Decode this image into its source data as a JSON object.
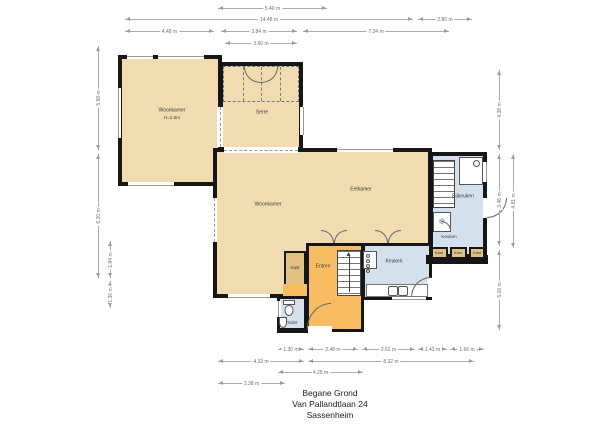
{
  "title": {
    "line1": "Begane Grond",
    "line2": "Van Pallandtlaan 24",
    "line3": "Sassenheim"
  },
  "colors": {
    "tan": "#f1dcb2",
    "tan2": "#e2c183",
    "orange": "#f8bc62",
    "blue": "#d4e1ec",
    "wall": "#161616",
    "dim_line": "#ababab",
    "dim_text": "#6f6f6f",
    "label_text": "#3c3c3c"
  },
  "plan": {
    "rooms": [
      {
        "id": "woonkamer-links",
        "x": 118,
        "y": 55,
        "w": 104,
        "h": 131,
        "fill": "tan",
        "bw": 4
      },
      {
        "id": "serre",
        "x": 219,
        "y": 62,
        "w": 84,
        "h": 89,
        "fill": "tan",
        "bw": 4
      },
      {
        "id": "woonkamer-eetkamer",
        "x": 213,
        "y": 148,
        "w": 219,
        "h": 150,
        "fill": "tan",
        "bw": 4
      },
      {
        "id": "bijkeuken",
        "x": 429,
        "y": 152,
        "w": 58,
        "h": 106,
        "fill": "blue",
        "bw": 4
      },
      {
        "id": "keuken",
        "x": 362,
        "y": 243,
        "w": 70,
        "h": 57,
        "fill": "blue",
        "bw": 3
      },
      {
        "id": "entree",
        "x": 306,
        "y": 243,
        "w": 58,
        "h": 89,
        "fill": "orange",
        "bw": 3
      },
      {
        "id": "kast-hal",
        "x": 284,
        "y": 251,
        "w": 22,
        "h": 36,
        "fill": "tan2",
        "bw": 2
      },
      {
        "id": "hal-strook",
        "x": 283,
        "y": 284,
        "w": 24,
        "h": 13,
        "fill": "orange",
        "noborder": true
      },
      {
        "id": "toilet",
        "x": 277,
        "y": 296,
        "w": 30,
        "h": 36,
        "fill": "blue",
        "bw": 3
      }
    ],
    "walls": [
      {
        "x": 426,
        "y": 255,
        "w": 62,
        "h": 9
      },
      {
        "x": 277,
        "y": 328,
        "w": 32,
        "h": 5
      }
    ],
    "windows": [
      {
        "x": 127,
        "y": 53,
        "w": 26,
        "h": 6,
        "o": "h"
      },
      {
        "x": 158,
        "y": 53,
        "w": 46,
        "h": 6,
        "o": "h"
      },
      {
        "x": 115,
        "y": 88,
        "w": 6,
        "h": 50,
        "o": "v"
      },
      {
        "x": 128,
        "y": 182,
        "w": 46,
        "h": 6,
        "o": "h"
      },
      {
        "x": 224,
        "y": 147,
        "w": 74,
        "h": 6,
        "o": "h",
        "dashed": true
      },
      {
        "x": 337,
        "y": 146,
        "w": 56,
        "h": 6,
        "o": "h"
      },
      {
        "x": 211,
        "y": 198,
        "w": 6,
        "h": 44,
        "o": "v",
        "dashed": true
      },
      {
        "x": 217,
        "y": 107,
        "w": 6,
        "h": 40,
        "o": "v",
        "dashed": true
      },
      {
        "x": 300,
        "y": 107,
        "w": 6,
        "h": 28,
        "o": "v"
      },
      {
        "x": 228,
        "y": 294,
        "w": 42,
        "h": 6,
        "o": "h"
      },
      {
        "x": 392,
        "y": 296,
        "w": 34,
        "h": 6,
        "o": "h"
      },
      {
        "x": 483,
        "y": 162,
        "w": 6,
        "h": 20,
        "o": "v"
      },
      {
        "x": 483,
        "y": 198,
        "w": 6,
        "h": 20,
        "o": "v",
        "door": true
      },
      {
        "x": 427,
        "y": 278,
        "w": 6,
        "h": 19,
        "o": "v",
        "door": true
      },
      {
        "x": 308,
        "y": 326,
        "w": 24,
        "h": 7,
        "o": "h",
        "door": true
      },
      {
        "x": 275,
        "y": 301,
        "w": 6,
        "h": 16,
        "o": "v"
      }
    ],
    "labels": [
      {
        "id": "woonkamer-links",
        "text": "Woonkamer",
        "x": 172,
        "y": 111,
        "size": 5
      },
      {
        "id": "woonkamer-links-height",
        "text": "H=2.8m",
        "x": 172,
        "y": 118,
        "size": 4.5
      },
      {
        "id": "serre",
        "text": "Serre",
        "x": 262,
        "y": 113,
        "size": 5
      },
      {
        "id": "woonkamer",
        "text": "Woonkamer",
        "x": 268,
        "y": 205,
        "size": 5
      },
      {
        "id": "eetkamer",
        "text": "Eetkamer",
        "x": 361,
        "y": 190,
        "size": 5
      },
      {
        "id": "bijkeuken",
        "text": "Bijkeuken",
        "x": 463,
        "y": 197,
        "size": 5
      },
      {
        "id": "keuken-hoek",
        "text": "Keuken",
        "x": 449,
        "y": 237,
        "size": 4.5
      },
      {
        "id": "keuken",
        "text": "Keuken",
        "x": 394,
        "y": 262,
        "size": 5
      },
      {
        "id": "entree",
        "text": "Entree",
        "x": 323,
        "y": 267,
        "size": 5
      },
      {
        "id": "kast-hal",
        "text": "Kast",
        "x": 295,
        "y": 268,
        "size": 4.5
      },
      {
        "id": "toilet",
        "text": "Toilet",
        "x": 292,
        "y": 323,
        "size": 4.5
      },
      {
        "id": "kast-1",
        "text": "Kast",
        "x": 439,
        "y": 253,
        "size": 4
      },
      {
        "id": "kast-2",
        "text": "Kast",
        "x": 458,
        "y": 253,
        "size": 4
      },
      {
        "id": "kast-3",
        "text": "Kast",
        "x": 477,
        "y": 253,
        "size": 4
      }
    ],
    "closets": [
      {
        "x": 431,
        "y": 247,
        "w": 17,
        "h": 12
      },
      {
        "x": 450,
        "y": 247,
        "w": 17,
        "h": 12
      },
      {
        "x": 469,
        "y": 247,
        "w": 16,
        "h": 12
      }
    ],
    "fixtures": [
      {
        "type": "closetband",
        "name": "wardrobe-band",
        "x": 223,
        "y": 66,
        "w": 76,
        "h": 36
      },
      {
        "type": "stairs",
        "name": "stairs-entree",
        "x": 337,
        "y": 250,
        "w": 24,
        "h": 46,
        "arrow": true
      },
      {
        "type": "stairs",
        "name": "stairs-bijkeuken",
        "x": 433,
        "y": 160,
        "w": 22,
        "h": 48
      },
      {
        "type": "shower",
        "name": "shower-tray",
        "x": 459,
        "y": 157,
        "w": 24,
        "h": 28
      },
      {
        "type": "freezer",
        "name": "freezer",
        "x": 433,
        "y": 212,
        "w": 18,
        "h": 20,
        "glyph": "❄"
      },
      {
        "type": "stove",
        "name": "stove",
        "x": 363,
        "y": 251,
        "w": 14,
        "h": 18
      },
      {
        "type": "counter",
        "name": "kitchen-counter",
        "x": 366,
        "y": 284,
        "w": 62,
        "h": 13
      },
      {
        "type": "sink2",
        "name": "double-sink",
        "x": 388,
        "y": 285,
        "w": 20,
        "h": 11
      },
      {
        "type": "toiletpan",
        "name": "toilet-pan",
        "x": 283,
        "y": 300,
        "w": 12,
        "h": 17
      },
      {
        "type": "handbasin",
        "name": "hand-basin",
        "x": 279,
        "y": 317,
        "w": 8,
        "h": 11
      }
    ],
    "arcs": [
      {
        "x": 307,
        "y": 303,
        "w": 24,
        "h": 26,
        "corner": "tl"
      },
      {
        "x": 321,
        "y": 230,
        "w": 13,
        "h": 13,
        "corner": "tr"
      },
      {
        "x": 334,
        "y": 230,
        "w": 13,
        "h": 13,
        "corner": "tl"
      },
      {
        "x": 375,
        "y": 230,
        "w": 13,
        "h": 13,
        "corner": "tr"
      },
      {
        "x": 388,
        "y": 230,
        "w": 13,
        "h": 13,
        "corner": "tl"
      },
      {
        "x": 487,
        "y": 198,
        "w": 20,
        "h": 20,
        "corner": "br"
      },
      {
        "x": 411,
        "y": 277,
        "w": 20,
        "h": 20,
        "corner": "tl"
      },
      {
        "x": 441,
        "y": 221,
        "w": 10,
        "h": 10,
        "corner": "tr"
      },
      {
        "x": 244,
        "y": 67,
        "w": 17,
        "h": 16,
        "corner": "bl"
      },
      {
        "x": 261,
        "y": 67,
        "w": 17,
        "h": 16,
        "corner": "br"
      }
    ],
    "dims": {
      "top": [
        {
          "label": "5.40 m",
          "x1": 218,
          "x2": 327,
          "y": 8
        },
        {
          "label": "14.48 m",
          "x1": 125,
          "x2": 413,
          "y": 19
        },
        {
          "label": "2.80 m",
          "x1": 418,
          "x2": 472,
          "y": 19
        },
        {
          "label": "4.48 m",
          "x1": 125,
          "x2": 214,
          "y": 31
        },
        {
          "label": "3.84 m",
          "x1": 221,
          "x2": 297,
          "y": 31
        },
        {
          "label": "7.34 m",
          "x1": 303,
          "x2": 449,
          "y": 31
        },
        {
          "label": "3.60 m",
          "x1": 225,
          "x2": 297,
          "y": 43
        }
      ],
      "bottom": [
        {
          "label": "1.30 m",
          "x1": 278,
          "x2": 304,
          "y": 349
        },
        {
          "label": "2.48 m",
          "x1": 308,
          "x2": 358,
          "y": 349
        },
        {
          "label": "2.62 m",
          "x1": 362,
          "x2": 415,
          "y": 349
        },
        {
          "label": "1.43 m",
          "x1": 418,
          "x2": 447,
          "y": 349
        },
        {
          "label": "1.66 m",
          "x1": 450,
          "x2": 484,
          "y": 349
        },
        {
          "label": "4.32 m",
          "x1": 218,
          "x2": 304,
          "y": 361
        },
        {
          "label": "8.32 m",
          "x1": 308,
          "x2": 474,
          "y": 361
        },
        {
          "label": "4.25 m",
          "x1": 278,
          "x2": 363,
          "y": 372
        },
        {
          "label": "3.38 m",
          "x1": 218,
          "x2": 285,
          "y": 383
        }
      ],
      "left": [
        {
          "label": "5.98 m",
          "x": 98,
          "y1": 46,
          "y2": 150
        },
        {
          "label": "6.20 m",
          "x": 98,
          "y1": 154,
          "y2": 278
        },
        {
          "label": "1.84 m",
          "x": 110,
          "y1": 241,
          "y2": 278
        },
        {
          "label": "1.36 m",
          "x": 110,
          "y1": 281,
          "y2": 308
        }
      ],
      "right": [
        {
          "label": "4.38 m",
          "x": 499,
          "y1": 70,
          "y2": 150
        },
        {
          "label": "3.46 m",
          "x": 499,
          "y1": 154,
          "y2": 246
        },
        {
          "label": "5.08 m",
          "x": 499,
          "y1": 250,
          "y2": 330
        },
        {
          "label": "4.81 m",
          "x": 513,
          "y1": 154,
          "y2": 248
        }
      ]
    }
  }
}
